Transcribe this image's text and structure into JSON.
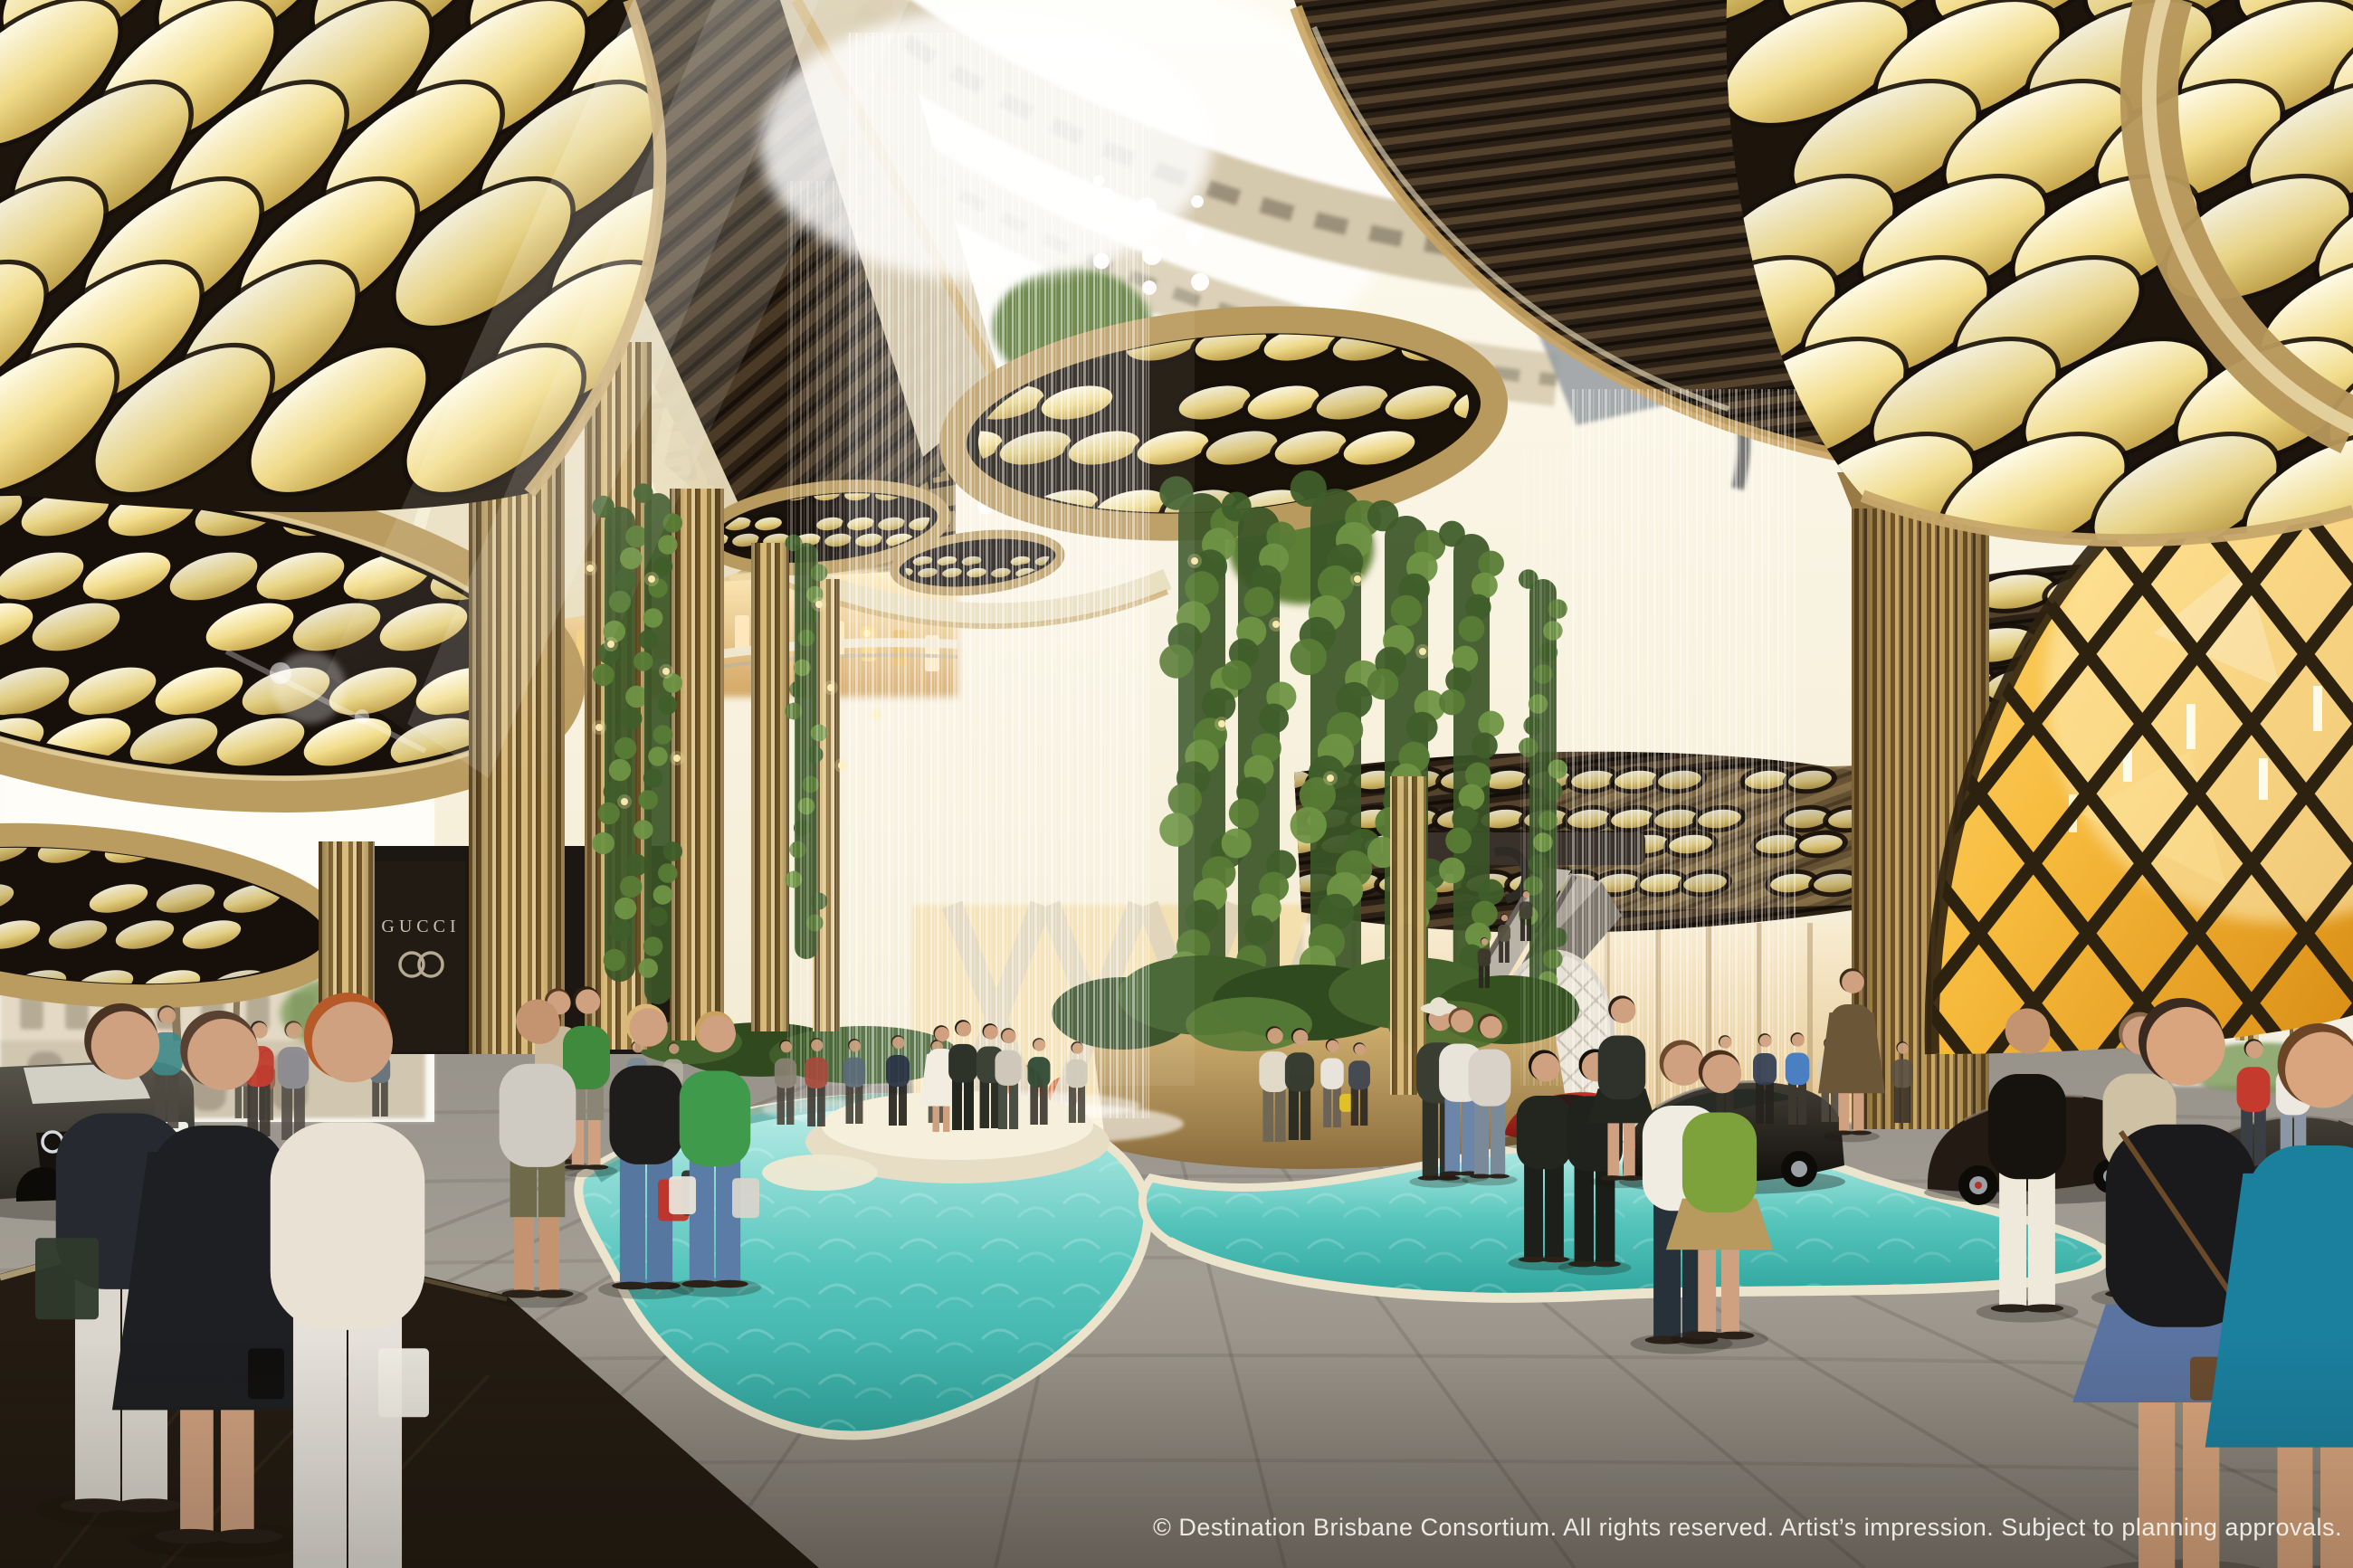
{
  "watermark": {
    "text": "© Destination Brisbane Consortium. All rights reserved. Artist’s impression. Subject to planning approvals."
  },
  "storefront": {
    "brand": "GUCCI",
    "logo_icon": "interlocking-gg-icon"
  },
  "vehicles": {
    "badge_icon": "audi-rings-icon",
    "cars_visible": [
      "dark sedan front",
      "red sports car",
      "dark coupe",
      "dark convertible",
      "dark sports car"
    ]
  },
  "colors": {
    "ceiling_dark": "#241a10",
    "gold_trim": "#c6a76a",
    "light_warm_bright": "#fdf8e0",
    "light_warm_deep": "#d8b955",
    "cream_ceiling": "#e9dfc2",
    "pool_teal": "#45bdb4",
    "pool_light": "#bdeee8",
    "floor_gray": "#8f8b83",
    "floor_dark": "#221a11",
    "amber_pavilion": "#f0a81f",
    "foliage_green": "#4a6b2f",
    "sky_glow": "#f7f3e4",
    "car_red": "#a8201d"
  }
}
